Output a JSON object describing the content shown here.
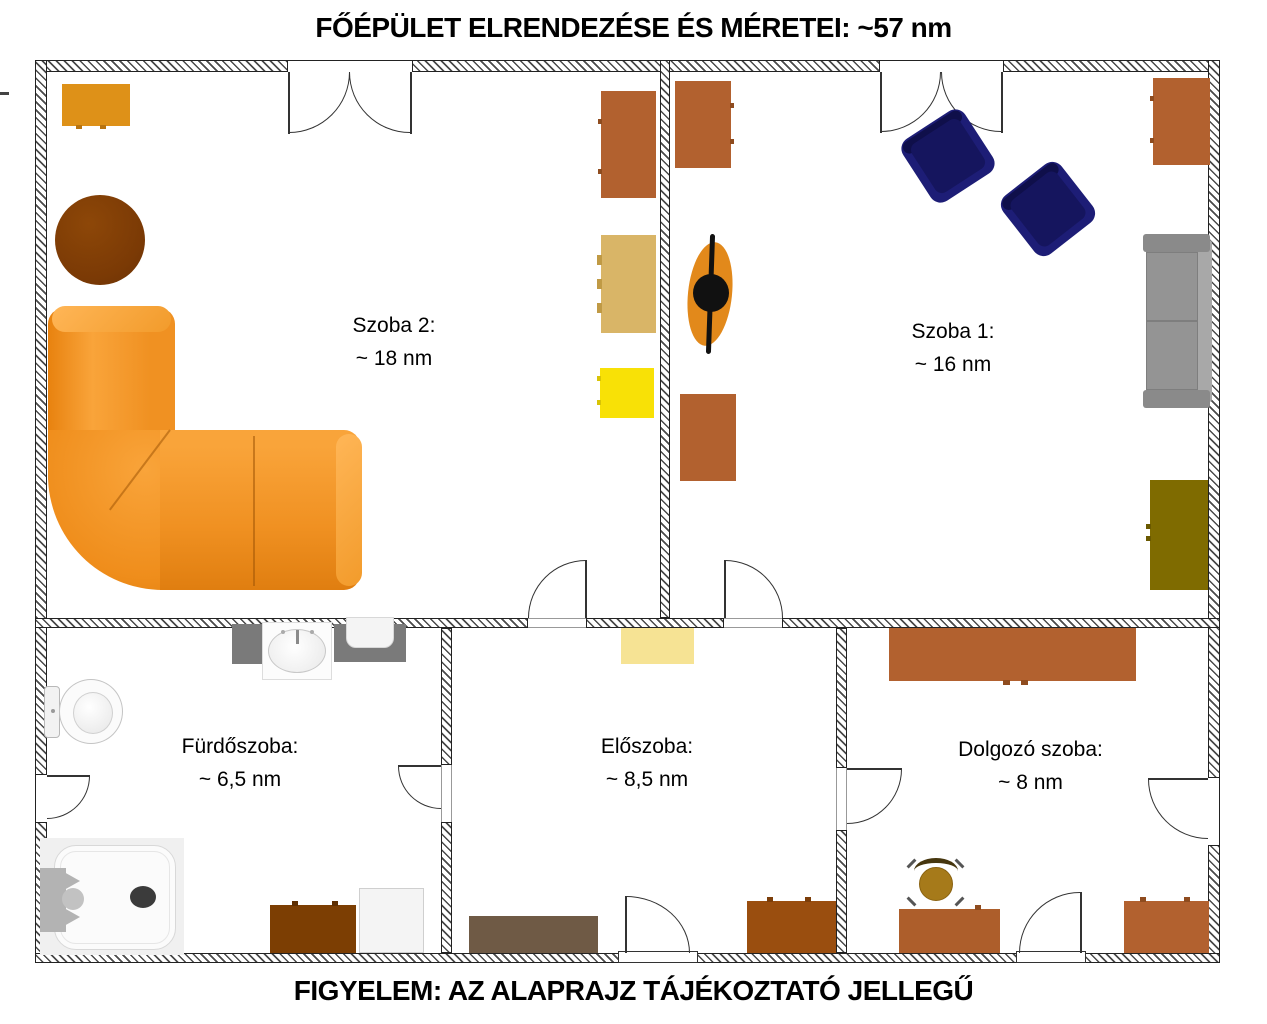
{
  "title": "FŐÉPÜLET ELRENDEZÉSE ÉS MÉRETEI: ~57 nm",
  "footer": "FIGYELEM: AZ ALAPRAJZ TÁJÉKOZTATÓ JELLEGŰ",
  "total_area": "~57 nm",
  "rooms": {
    "szoba2": {
      "name": "Szoba 2:",
      "area": "~ 18 nm"
    },
    "szoba1": {
      "name": "Szoba 1:",
      "area": "~ 16 nm"
    },
    "furdoszoba": {
      "name": "Fürdőszoba:",
      "area": "~ 6,5 nm"
    },
    "eloszoba": {
      "name": "Előszoba:",
      "area": "~ 8,5 nm"
    },
    "dolgozoszoba": {
      "name": "Dolgozó szoba:",
      "area": "~ 8 nm"
    }
  },
  "furniture": {
    "szoba2": [
      "orange-dresser",
      "round-table-brown",
      "corner-sofa-orange",
      "wardrobe-sienna",
      "dresser-tan",
      "nightstand-yellow"
    ],
    "szoba1": [
      "cabinet-sienna-top",
      "decor-plant-orange",
      "cabinet-sienna-bottom",
      "armchair-navy-1",
      "armchair-navy-2",
      "dresser-sienna-right",
      "sofa-gray",
      "cabinet-olive"
    ],
    "furdoszoba": [
      "toilet",
      "cabinet-gray",
      "sink",
      "washing-machine",
      "shower-tray",
      "cabinet-dark-brown",
      "cabinet-white"
    ],
    "eloszoba": [
      "shelf-pale-yellow",
      "bench-taupe",
      "cabinet-chestnut"
    ],
    "dolgozoszoba": [
      "wardrobe-sienna-wide",
      "office-chair",
      "desk-sienna",
      "cabinet-sienna-br"
    ]
  },
  "colors": {
    "wall_line": "#222222",
    "sofa_orange": "#F2921F",
    "dresser_orange": "#DE9118",
    "table_brown": "#7B3A05",
    "cabinet_sienna": "#B2612F",
    "dresser_tan": "#D9B567",
    "nightstand_yellow": "#F8E106",
    "armchair_navy": "#1D1D76",
    "sofa_gray": "#939393",
    "cabinet_olive": "#7F6B00",
    "shelf_pale_yellow": "#F6E394",
    "bench_taupe": "#6F5A45",
    "cabinet_chestnut": "#9A4E0F",
    "cabinet_dark_brown": "#7C3E03",
    "desk_sienna": "#AD5E2B",
    "office_chair_ochre": "#A67A1A",
    "decor_orange": "#E2891B"
  }
}
